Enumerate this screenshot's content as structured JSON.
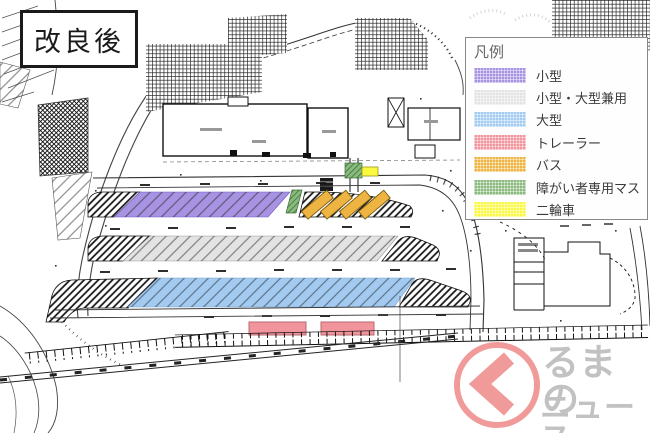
{
  "title_box": {
    "label": "改良後"
  },
  "legend": {
    "title": "凡例",
    "items": [
      {
        "label": "小型",
        "color": "#a793e1"
      },
      {
        "label": "小型・大型兼用",
        "color": "#e3e3e3"
      },
      {
        "label": "大型",
        "color": "#a3cbf1"
      },
      {
        "label": "トレーラー",
        "color": "#f2949c"
      },
      {
        "label": "バス",
        "color": "#eeb441"
      },
      {
        "label": "障がい者専用マス",
        "color": "#8aba7e"
      },
      {
        "label": "二輪車",
        "color": "#fbf840"
      }
    ]
  },
  "logo": {
    "word_first_char": "く",
    "line1": "るまの",
    "line2": "ニュース",
    "ring_color": "#ef8585",
    "text_color": "#b5b5b5"
  }
}
